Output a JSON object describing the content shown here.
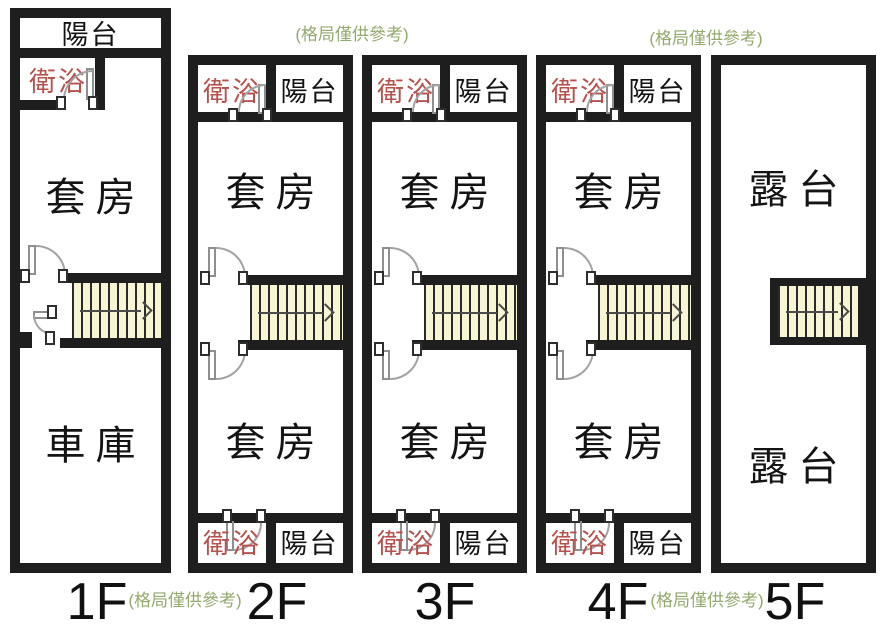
{
  "annotations": {
    "reference_note": "(格局僅供參考)"
  },
  "rooms": {
    "balcony": "陽台",
    "bathroom": "衛浴",
    "suite": "套房",
    "garage": "車庫",
    "terrace": "露台"
  },
  "floors": [
    {
      "label": "1F"
    },
    {
      "label": "2F"
    },
    {
      "label": "3F"
    },
    {
      "label": "4F"
    },
    {
      "label": "5F"
    }
  ],
  "stairs": {
    "direction": "right"
  },
  "colors": {
    "wall": "#1e1e1e",
    "stair_fill": "#f7f5d3",
    "bathroom_label": "#b5524e",
    "note_green": "#94a96e"
  }
}
